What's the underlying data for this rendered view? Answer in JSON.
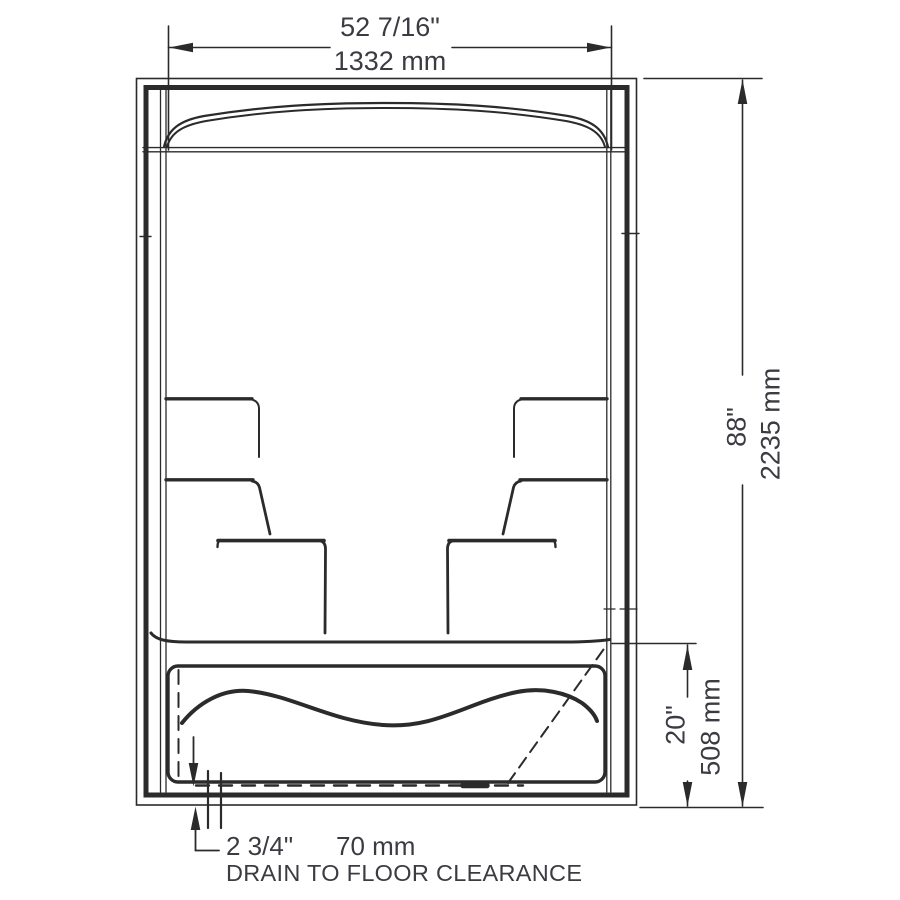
{
  "colors": {
    "background": "#ffffff",
    "line": "#2b2b2b",
    "text": "#3b3b42"
  },
  "dimensions": {
    "overall_width": {
      "imperial": "52 7/16\"",
      "metric": "1332 mm"
    },
    "overall_height": {
      "imperial": "88\"",
      "metric": "2235 mm"
    },
    "base_height": {
      "imperial": "20\"",
      "metric": "508 mm"
    },
    "drain_to_floor": {
      "imperial": "2 3/4\"",
      "metric": "70 mm",
      "caption": "DRAIN TO FLOOR CLEARANCE"
    }
  }
}
